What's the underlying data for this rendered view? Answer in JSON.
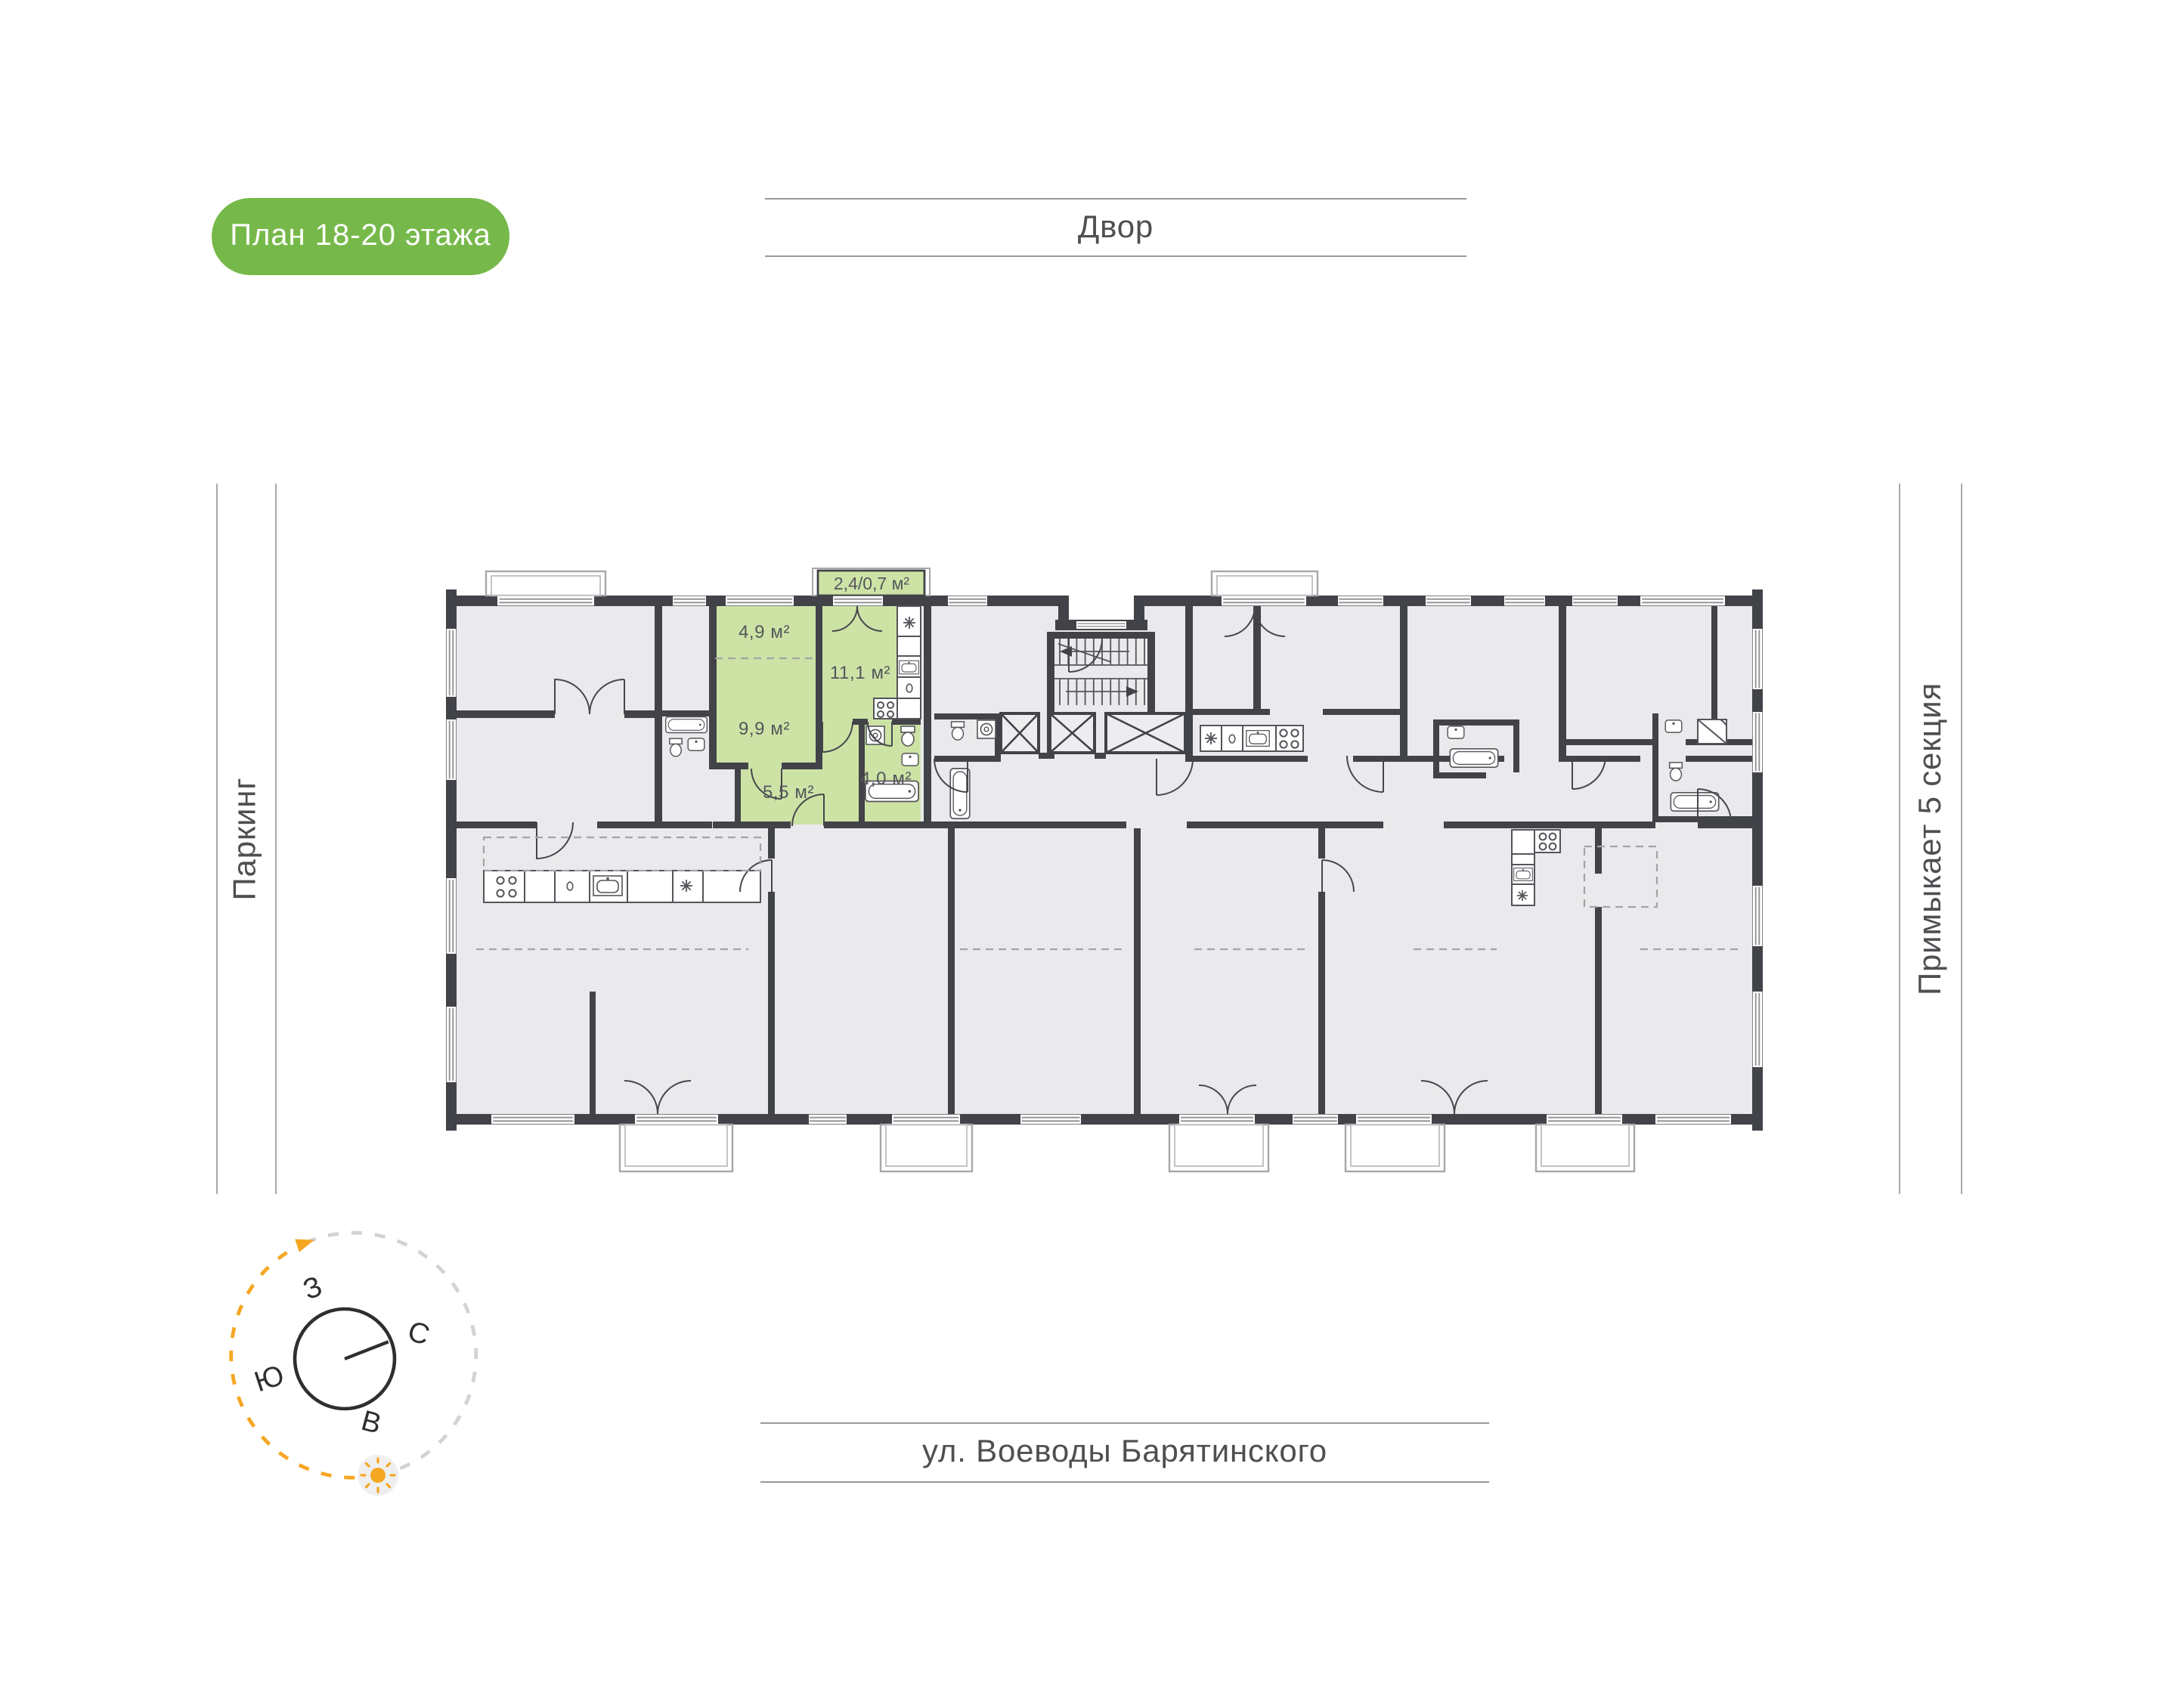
{
  "badge": {
    "label": "План 18-20 этажа",
    "bg_color": "#76B94A"
  },
  "surroundings": {
    "top": "Двор",
    "left": "Паркинг",
    "right": "Примыкает 5 секция",
    "bottom": "ул. Воеводы Барятинского"
  },
  "compass": {
    "west": "З",
    "north": "С",
    "south": "Ю",
    "east": "В"
  },
  "unit": {
    "labels": [
      "2,4/0,7 м²",
      "4,9 м²",
      "11,1 м²",
      "9,9 м²",
      "5,5 м²",
      "4,0 м²"
    ],
    "highlight_color": "#CDE3A6"
  },
  "colors": {
    "wall": "#414348",
    "room_fill": "#EAEAEC",
    "accent_orange": "#F5A623",
    "label_text": "#55565B"
  }
}
